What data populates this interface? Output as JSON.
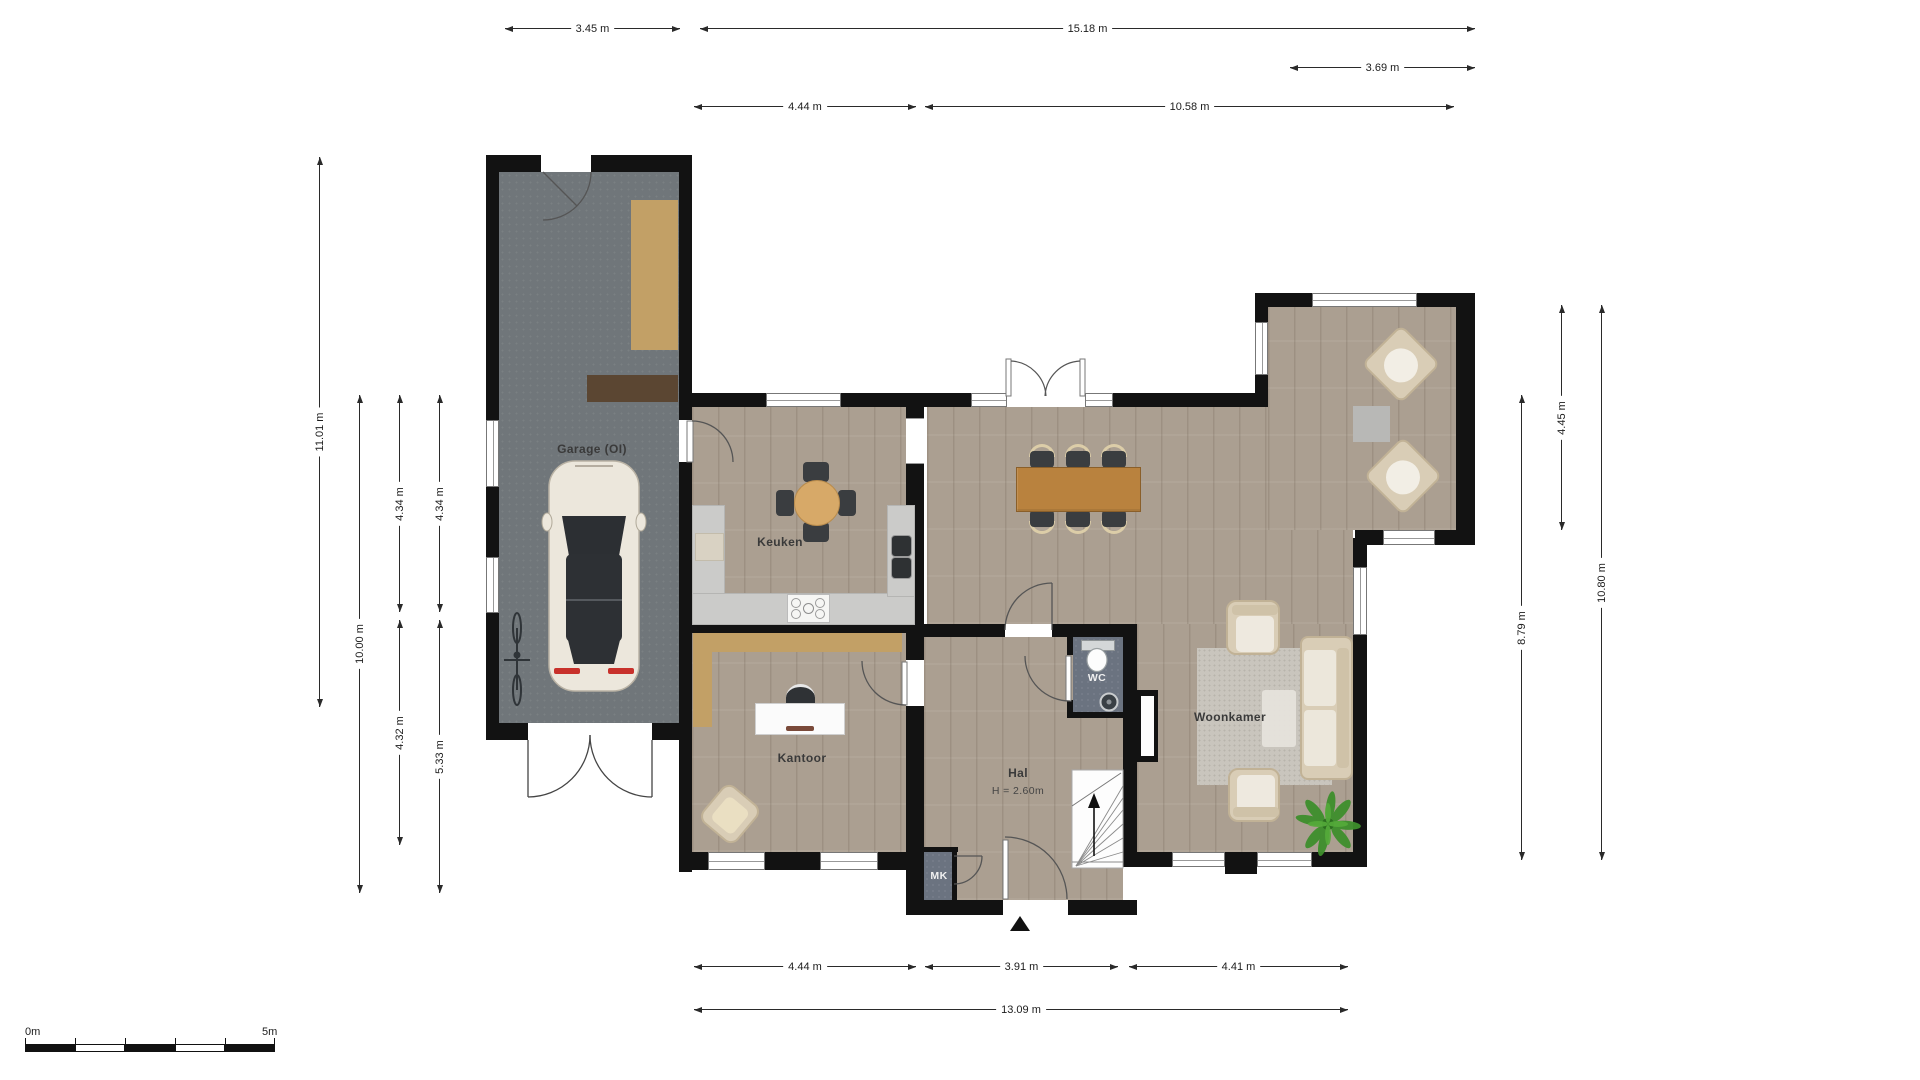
{
  "plan": {
    "type": "floor-plan",
    "language": "Dutch",
    "rooms": {
      "garage": {
        "name": "Garage (OI)"
      },
      "keuken": {
        "name": "Keuken"
      },
      "kantoor": {
        "name": "Kantoor"
      },
      "hal": {
        "name": "Hal",
        "ceiling_height": "H = 2.60m"
      },
      "wc": {
        "name": "WC"
      },
      "mk": {
        "name": "MK"
      },
      "woonkamer": {
        "name": "Woonkamer"
      }
    },
    "dimensions": {
      "top": [
        {
          "label": "3.45 m"
        },
        {
          "label": "15.18 m"
        },
        {
          "label": "3.69 m"
        },
        {
          "label": "4.44 m"
        },
        {
          "label": "10.58 m"
        }
      ],
      "bottom": [
        {
          "label": "4.44 m"
        },
        {
          "label": "3.91 m"
        },
        {
          "label": "4.41 m"
        },
        {
          "label": "13.09 m"
        }
      ],
      "left": [
        {
          "label": "11.01 m"
        },
        {
          "label": "10.00 m"
        },
        {
          "label": "4.34 m"
        },
        {
          "label": "4.32 m"
        },
        {
          "label": "4.34 m"
        },
        {
          "label": "5.33 m"
        }
      ],
      "right": [
        {
          "label": "4.45 m"
        },
        {
          "label": "10.80 m"
        },
        {
          "label": "8.79 m"
        }
      ]
    },
    "scale_bar": {
      "start_label": "0m",
      "end_label": "5m",
      "length_m": 5
    },
    "colors": {
      "wall": "#121212",
      "wood_floor": "#ab9f91",
      "garage_floor": "#70767a",
      "wet_room_floor": "#6b7380",
      "counter": "#cbcbc9",
      "cabinet_tan": "#c2a066",
      "shelf_brown": "#5b4632",
      "table_wood": "#b9823e",
      "round_table_wood": "#d7a968",
      "seat_beige": "#d9cdb6",
      "rug": "#c9c5bd",
      "plant_green": "#3e8f2c",
      "taillight_red": "#c8312b"
    }
  }
}
